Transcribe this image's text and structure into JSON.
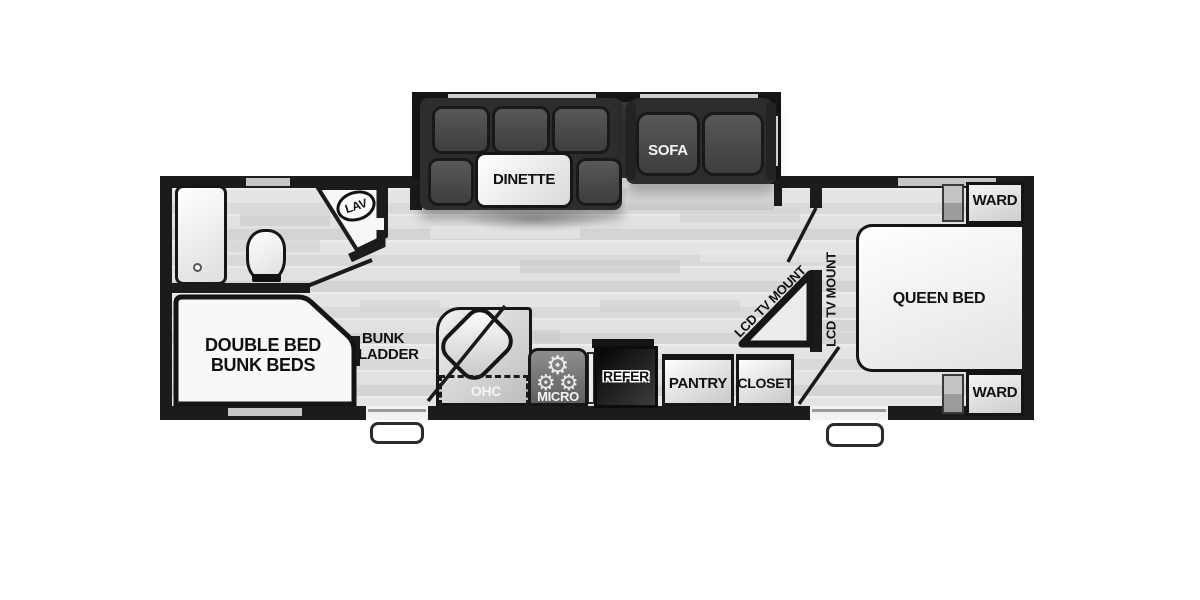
{
  "plan": {
    "type": "travel-trailer-floor-plan",
    "slideout": {
      "dinette_label": "DINETTE",
      "sofa_label": "SOFA"
    },
    "bathroom": {
      "lav_label": "LAV"
    },
    "bunk_room": {
      "bed_label_line1": "DOUBLE BED",
      "bed_label_line2": "BUNK BEDS",
      "ladder_label_line1": "BUNK",
      "ladder_label_line2": "LADDER"
    },
    "galley": {
      "ohc_label": "OHC",
      "micro_label": "MICRO",
      "refer_label": "REFER",
      "pantry_label": "PANTRY",
      "closet_label": "CLOSET",
      "burner_glyph": "⚙"
    },
    "living": {
      "tv_mount_label": "LCD TV MOUNT"
    },
    "bedroom": {
      "queen_bed_label": "QUEEN BED",
      "ward_top_label": "WARD",
      "ward_bottom_label": "WARD",
      "tv_mount_label": "LCD TV MOUNT"
    }
  },
  "colors": {
    "wall": "#1b1b1b",
    "slideout_bg": "#3a3a3a",
    "cushion": "#4a4a4a",
    "floor_light": "#e4e4e4",
    "floor_mid": "#d4d4d4",
    "fixture_white": "#fafafa",
    "appliance_black": "#101010",
    "cabinet_gray": "#9e9e9e"
  }
}
